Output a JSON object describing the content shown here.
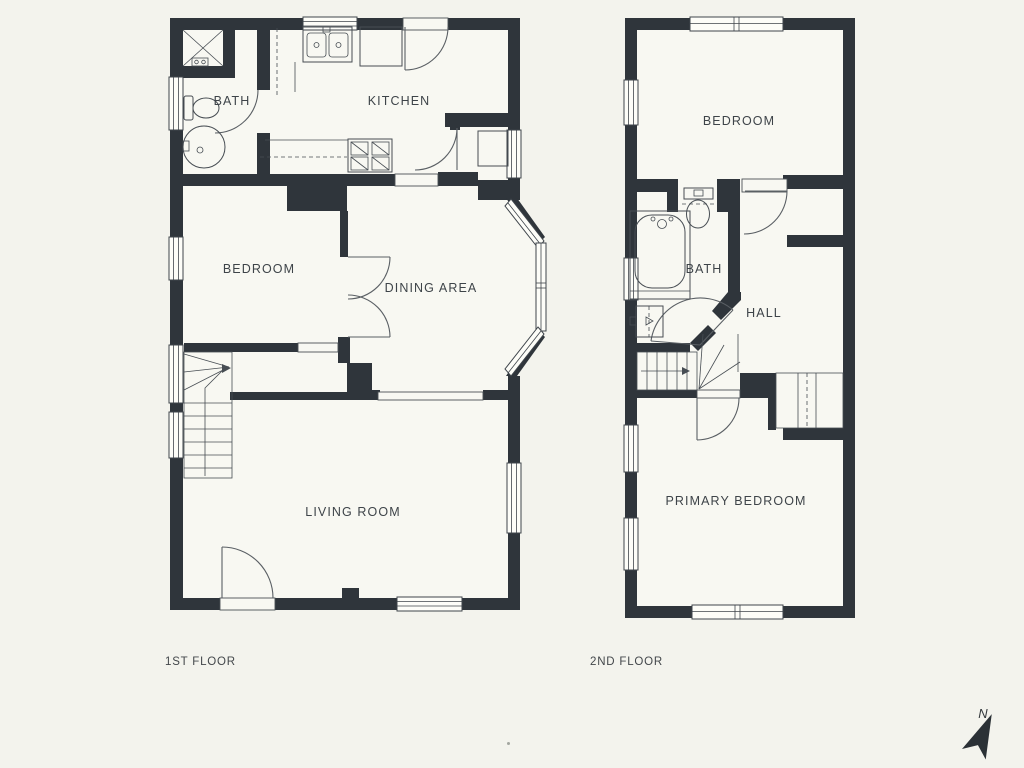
{
  "title": "Two-storey house floor plan",
  "floors": [
    {
      "caption": "1ST FLOOR",
      "rooms": [
        {
          "label": "BATH"
        },
        {
          "label": "KITCHEN"
        },
        {
          "label": "BEDROOM"
        },
        {
          "label": "DINING AREA"
        },
        {
          "label": "LIVING ROOM"
        }
      ],
      "fixtures": [
        "shower",
        "toilet",
        "pedestal-sink",
        "kitchen-sink",
        "refrigerator",
        "stove",
        "stairs",
        "bay-window",
        "entry-landing"
      ]
    },
    {
      "caption": "2ND FLOOR",
      "rooms": [
        {
          "label": "BEDROOM"
        },
        {
          "label": "BATH"
        },
        {
          "label": "HALL"
        },
        {
          "label": "PRIMARY BEDROOM"
        }
      ],
      "fixtures": [
        "toilet",
        "bathtub",
        "sink",
        "stairs",
        "closet"
      ]
    }
  ],
  "compass": {
    "label": "N"
  },
  "colors": {
    "background": "#f3f3ed",
    "floor": "#f8f8f2",
    "wall": "#2f353b",
    "line": "#474d53",
    "text": "#3e4449"
  }
}
